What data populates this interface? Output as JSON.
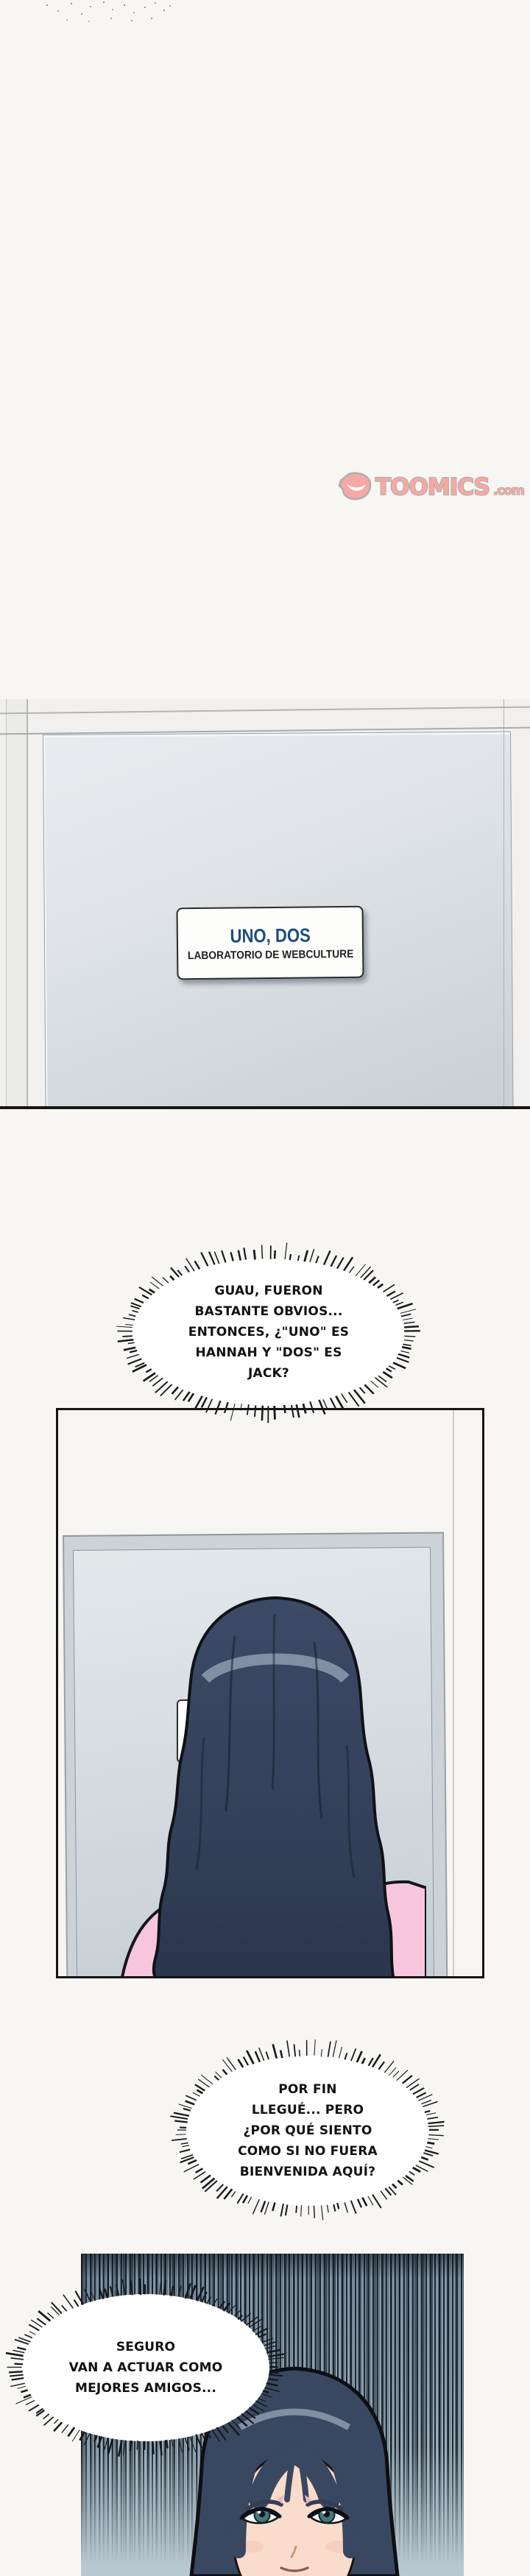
{
  "page": {
    "kind": "webtoon episode page"
  },
  "logo": {
    "text": "TOOMICS",
    "suffix": ".com",
    "pink": "#f5a9a4",
    "outline": "#b3adaa"
  },
  "door_sign": {
    "line1": "UNO, DOS",
    "line2": "LABORATORIO DE WEBCULTURE",
    "line1_color": "#1d4c7f"
  },
  "hall_sign": {
    "text": "LABO"
  },
  "bubbles": [
    {
      "lines": [
        "GUAU, FUERON",
        "BASTANTE OBVIOS...",
        "ENTONCES, ¿\"UNO\" ES",
        "HANNAH Y \"DOS\" ES",
        "JACK?"
      ]
    },
    {
      "lines": [
        "POR FIN",
        "LLEGUÉ... PERO",
        "¿POR QUÉ SIENTO",
        "COMO SI NO FUERA",
        "BIENVENIDA AQUÍ?"
      ]
    },
    {
      "lines": [
        "SEGURO",
        "VAN A ACTUAR COMO",
        "MEJORES AMIGOS..."
      ]
    }
  ],
  "colors": {
    "hair": "#3a4760",
    "hair_dark": "#2c3750",
    "hair_highlight": "#94a0b4",
    "shirt_pink": "#f8c6dc",
    "skin": "#f9dccb",
    "eye_teal": "#49767c",
    "panel3_bg": "#8da2b0",
    "door_gray": "#d6dce1"
  }
}
